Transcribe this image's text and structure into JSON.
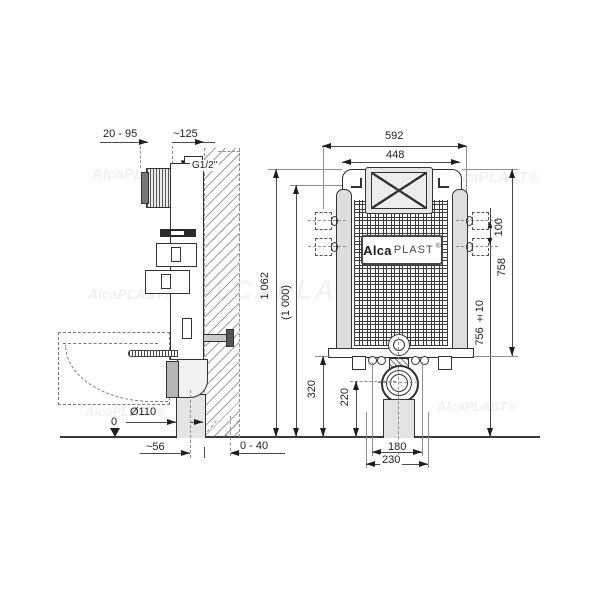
{
  "logo": {
    "alca": "Alca",
    "plast": "PLAST",
    "reg": "®"
  },
  "watermarks": {
    "small": "AlcaPLAST®",
    "large": "ALCAPLAST.SK"
  },
  "side_view": {
    "dim_inlet_range": "20 - 95",
    "dim_depth": "~125",
    "inlet_thread": "G1/2\"",
    "dim_outlet_dia": "Ø110",
    "floor_zero": "0",
    "dim_outlet_offset": "~56",
    "dim_wall_finish": "0 - 40"
  },
  "front_view": {
    "dim_outer_width": "592",
    "dim_inner_width": "448",
    "dim_total_height": "1 062",
    "dim_ref_height": "(1 000)",
    "dim_body_height": "758",
    "dim_fixing_height": "756 ±10",
    "dim_fixing_gap": "100",
    "dim_base_height": "320",
    "dim_outlet_axis": "220",
    "dim_bolt_gap": "180",
    "dim_outlet_gap": "230"
  }
}
